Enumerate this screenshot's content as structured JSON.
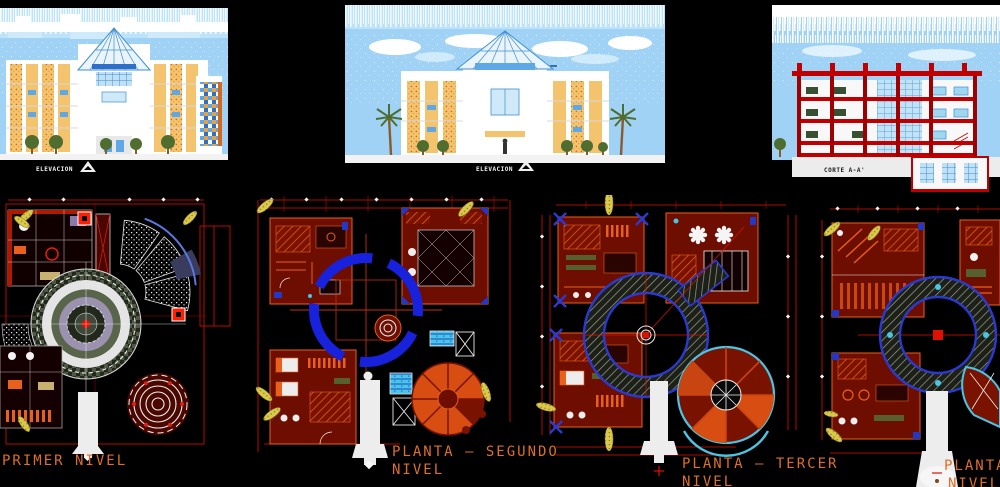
{
  "canvas": {
    "width": 1000,
    "height": 487,
    "background": "#000000"
  },
  "drawing_labels": {
    "elevation_left": "ELEVACION",
    "elevation_center": "ELEVACION",
    "section_right": "CORTE A-A'",
    "plan_first": "PRIMER NIVEL",
    "plan_second_line1": "PLANTA – SEGUNDO",
    "plan_second_line2": "NIVEL",
    "plan_third_line1": "PLANTA – TERCER",
    "plan_third_line2": "NIVEL",
    "plan_fourth_line1": "PLANTA",
    "plan_fourth_line2": "NIVEL"
  },
  "icons": {
    "elevation_marker_left": "triangle-up",
    "elevation_marker_center": "triangle-up"
  },
  "colors": {
    "background": "#000000",
    "label_orange": "#DD6F28",
    "cad_red": "#E8190C",
    "wall_maroon": "#701000",
    "furniture_orange": "#E8601C",
    "ring_blue": "#1822DC",
    "water_cyan": "#49C6E6",
    "palm_yellow": "#D9C94B",
    "sky_blue": "#9FD2F5",
    "cloud_white": "#FFFFFF",
    "facade_cream": "#F3C36E",
    "glass_blue": "#5FA8E8",
    "section_red": "#C00000"
  }
}
